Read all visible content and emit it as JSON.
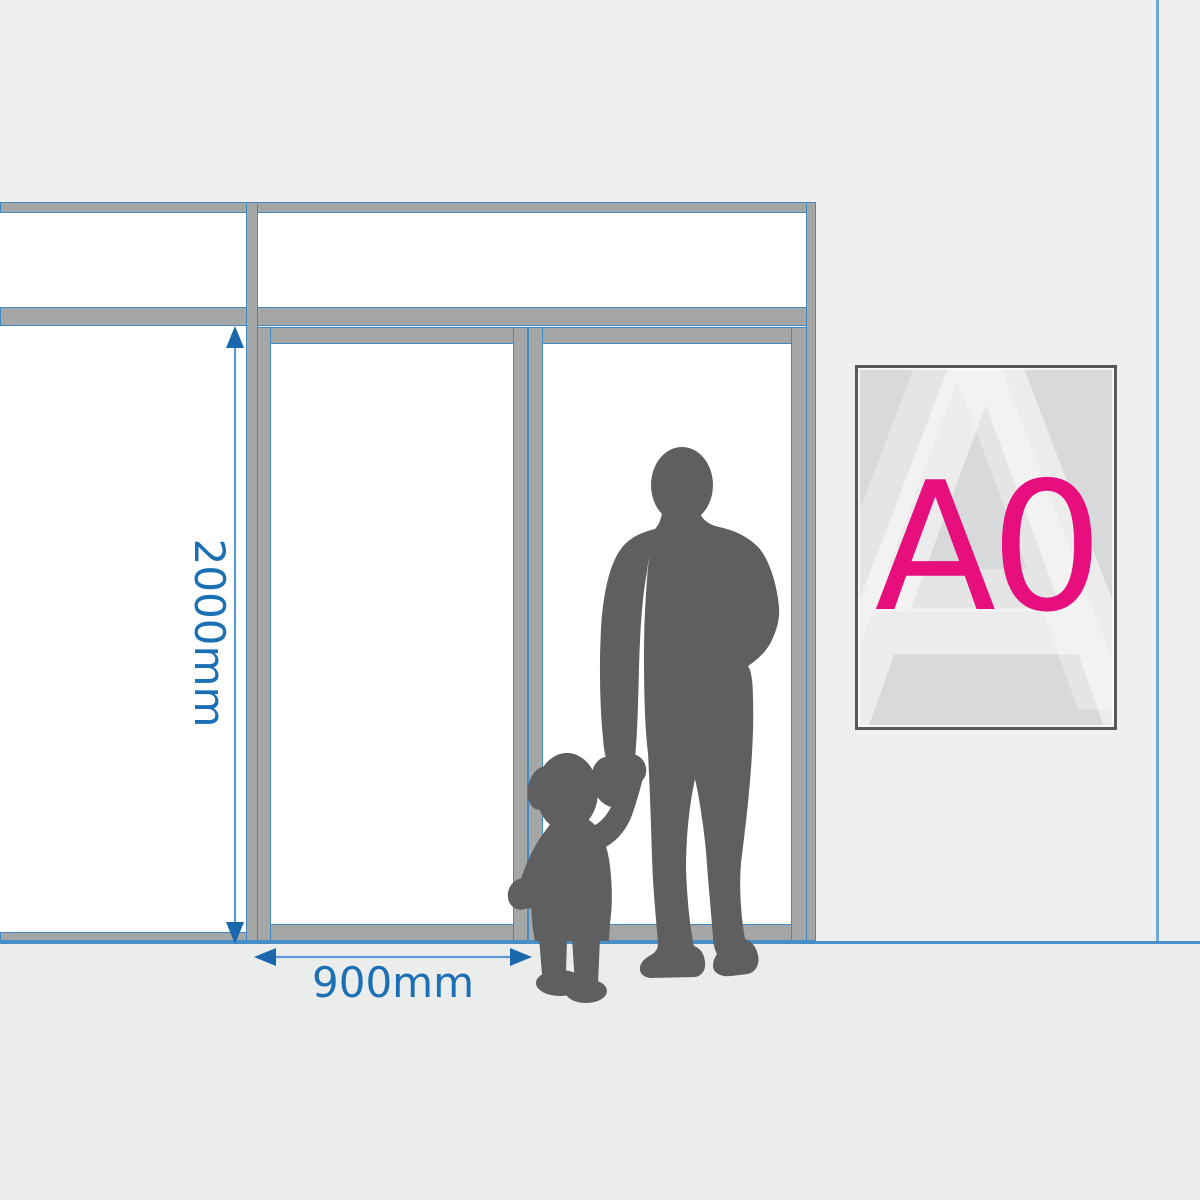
{
  "diagram": {
    "height_dimension": "2000mm",
    "width_dimension": "900mm"
  },
  "poster": {
    "label": "A0",
    "watermark_letter": "A"
  },
  "colors": {
    "wall": "#efefef",
    "floor": "#ebecec",
    "glass": "#ffffff",
    "frame-gray": "#a5a6a6",
    "frame-blue": "#4389c4",
    "dim-line": "#5b9bd5",
    "dim-arrow": "#1a67ad",
    "dim-text": "#1b6fb5",
    "silhouette": "#5f5f5f",
    "poster-border": "#58595b",
    "poster-fill": "#d8d9da",
    "poster-accent": "#e60f7d",
    "corner-line": "#6fabd0",
    "floor-line": "#4a90c8"
  }
}
